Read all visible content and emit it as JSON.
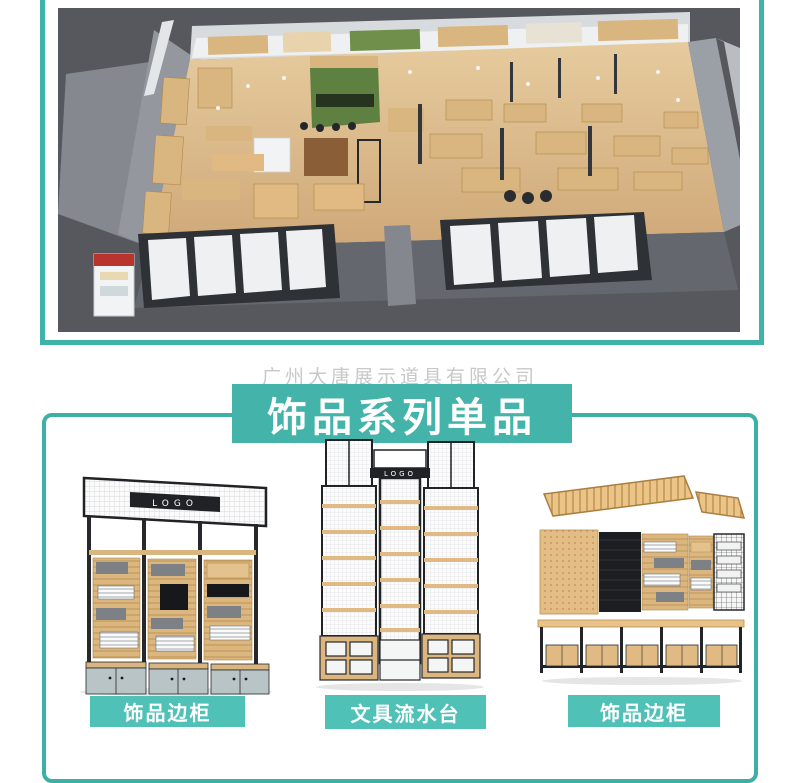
{
  "colors": {
    "accent": "#44b4aa",
    "accent_light": "#4fc1b6",
    "outline": "#3cb0a7",
    "photo_background": "#56585d"
  },
  "watermark": {
    "text": "广州大唐展示道具有限公司"
  },
  "hero": {
    "name": "store-interior-3d-render"
  },
  "section": {
    "title": "饰品系列单品"
  },
  "products": [
    {
      "label": "饰品边柜",
      "logo_text": "LOGO"
    },
    {
      "label": "文具流水台",
      "logo_text": "LOGO"
    },
    {
      "label": "饰品边柜"
    }
  ]
}
